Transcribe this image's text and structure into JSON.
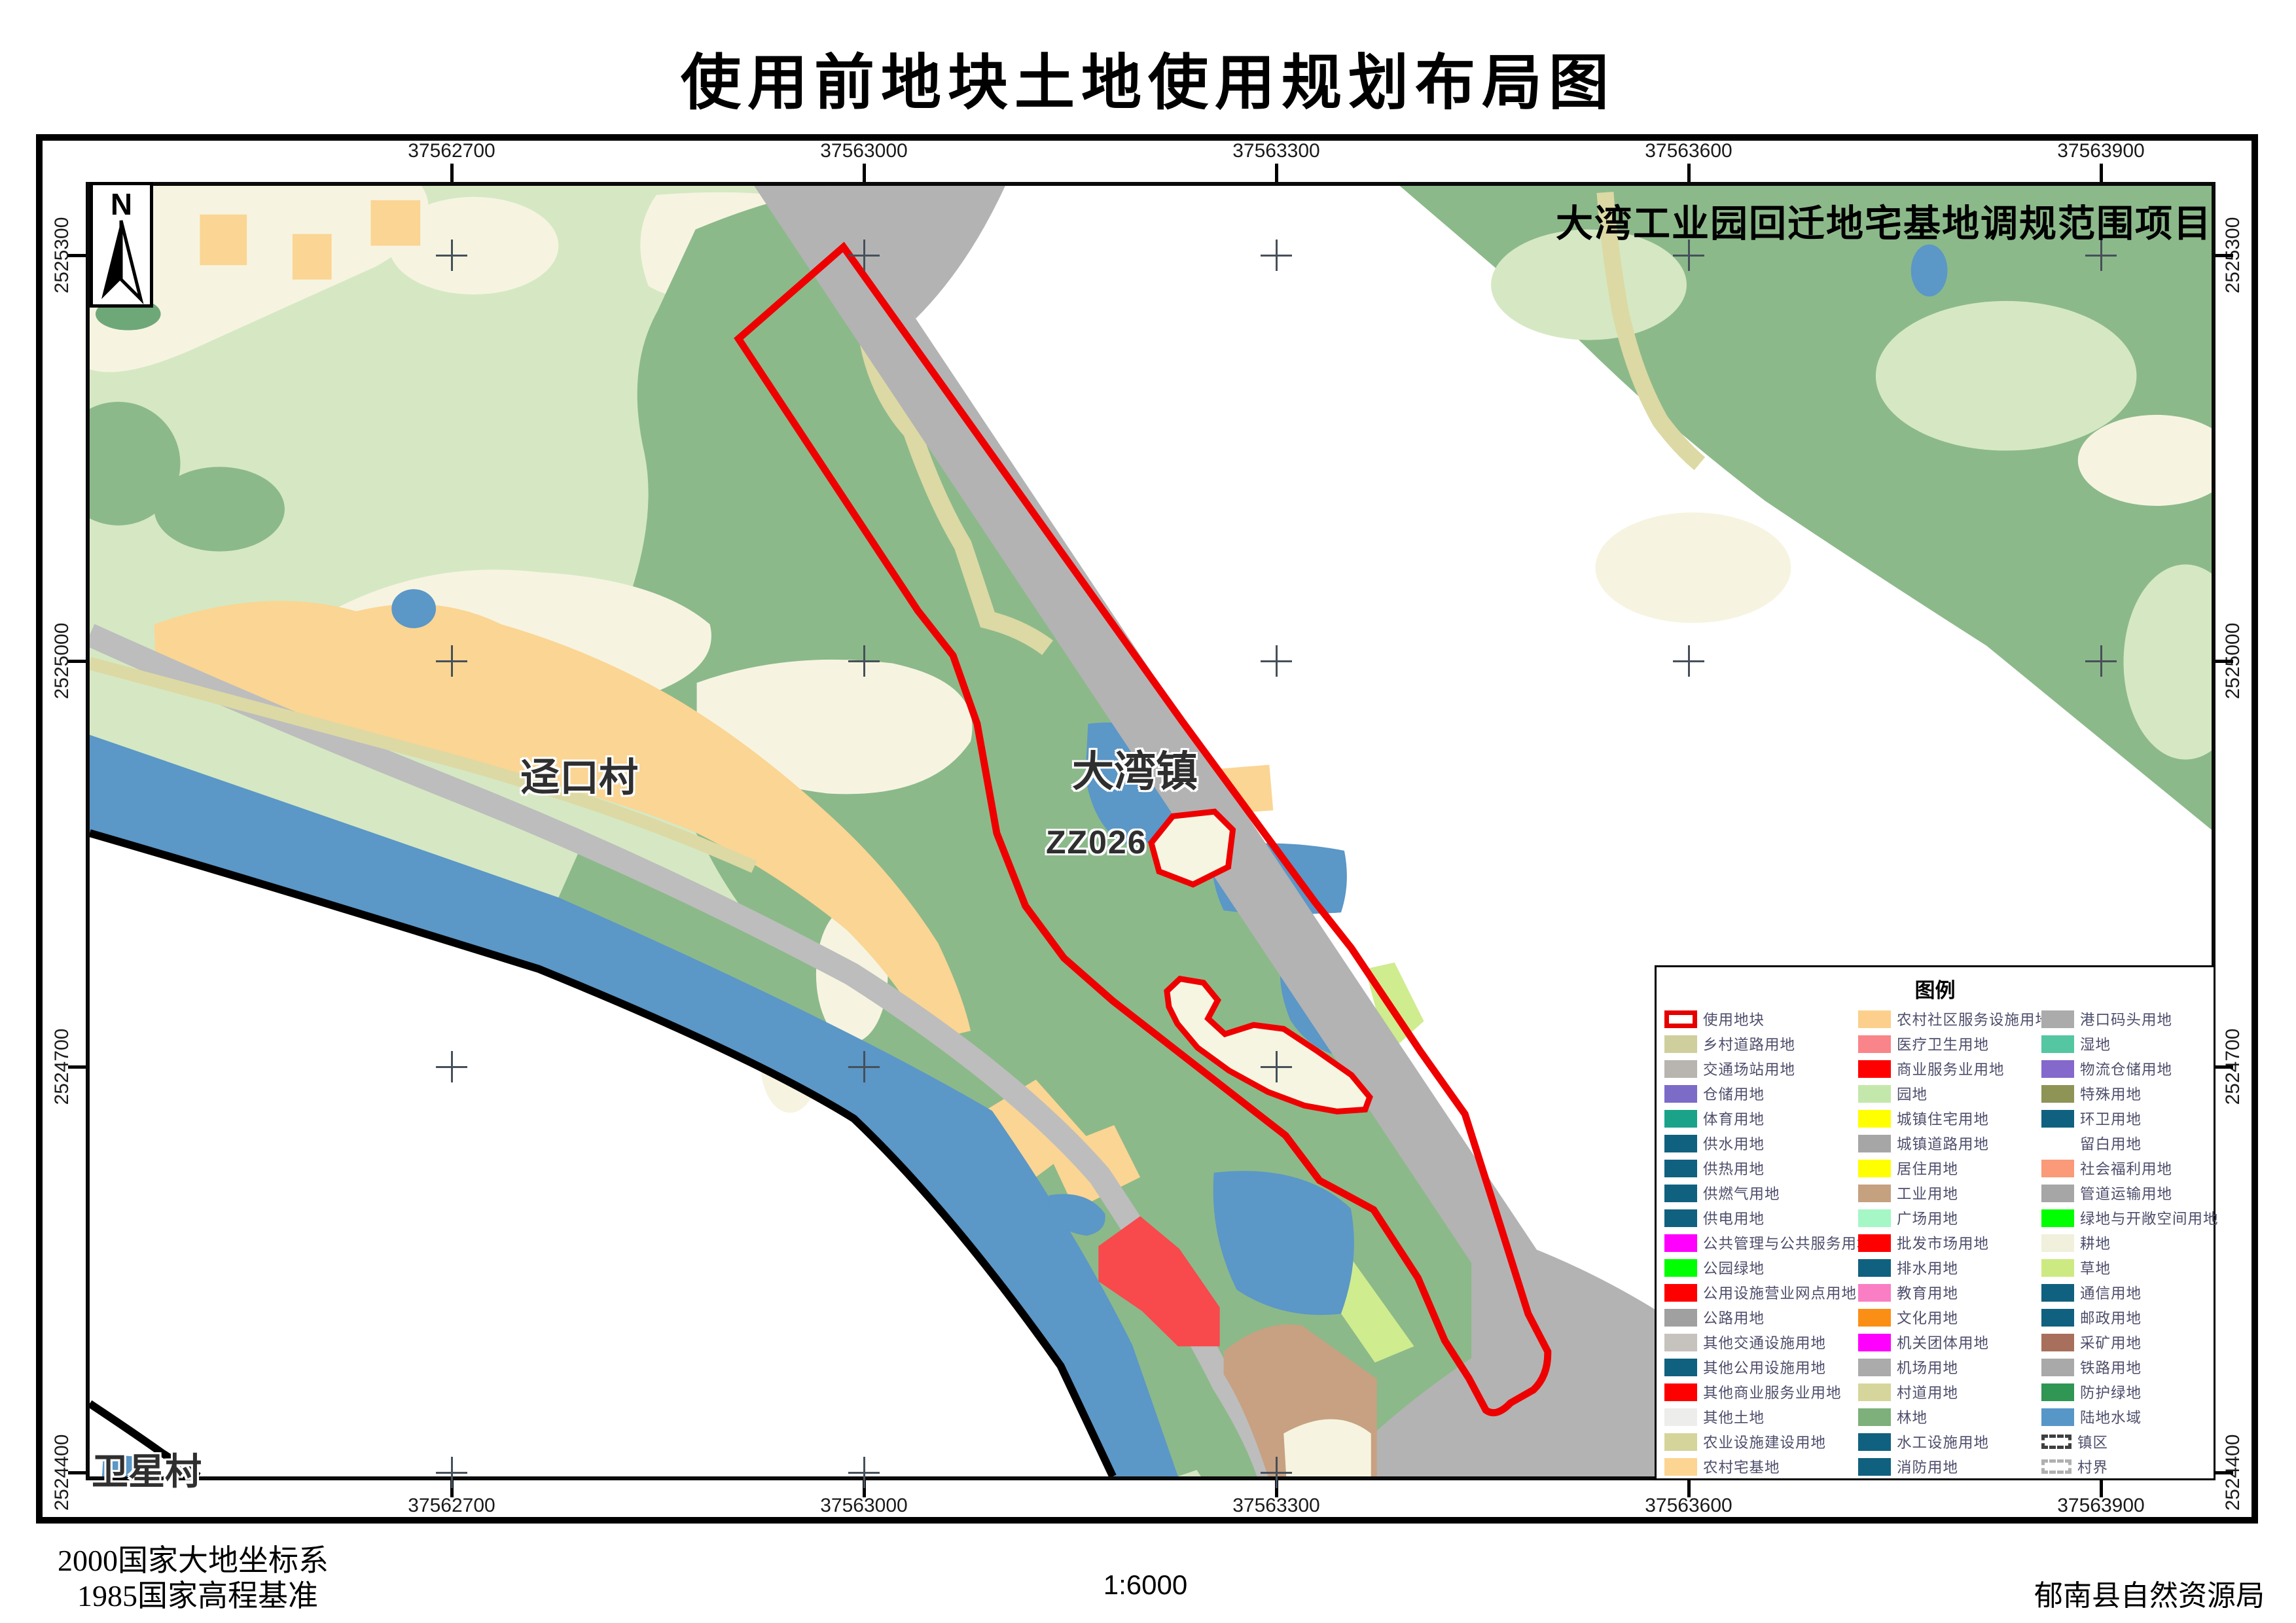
{
  "page": {
    "title": "使用前地块土地使用规划布局图"
  },
  "map": {
    "project_label": "大湾工业园回迁地宅基地调规范围项目",
    "north_label": "N",
    "labels": {
      "jingkou": "迳口村",
      "dawan": "大湾镇",
      "parcel_code": "ZZ026",
      "weixing": "卫星村"
    }
  },
  "grid": {
    "eastings": [
      "37562700",
      "37563000",
      "37563300",
      "37563600",
      "37563900"
    ],
    "northings": [
      "2525300",
      "2525000",
      "2524700",
      "2524400"
    ]
  },
  "legend": {
    "title": "图例",
    "columns": [
      [
        {
          "label": "使用地块",
          "swatch": "outline",
          "color": "#e60000"
        },
        {
          "label": "乡村道路用地",
          "swatch": "fill",
          "color": "#cfcf9e"
        },
        {
          "label": "交通场站用地",
          "swatch": "fill",
          "color": "#b8b4b0"
        },
        {
          "label": "仓储用地",
          "swatch": "fill",
          "color": "#7d6bc8"
        },
        {
          "label": "体育用地",
          "swatch": "fill",
          "color": "#1aa389"
        },
        {
          "label": "供水用地",
          "swatch": "fill",
          "color": "#10617f"
        },
        {
          "label": "供热用地",
          "swatch": "fill",
          "color": "#10617f"
        },
        {
          "label": "供燃气用地",
          "swatch": "fill",
          "color": "#10617f"
        },
        {
          "label": "供电用地",
          "swatch": "fill",
          "color": "#10617f"
        },
        {
          "label": "公共管理与公共服务用地",
          "swatch": "fill",
          "color": "#ff00ff"
        },
        {
          "label": "公园绿地",
          "swatch": "fill",
          "color": "#00ff00"
        },
        {
          "label": "公用设施营业网点用地",
          "swatch": "fill",
          "color": "#ff0000"
        },
        {
          "label": "公路用地",
          "swatch": "fill",
          "color": "#a0a0a0"
        },
        {
          "label": "其他交通设施用地",
          "swatch": "fill",
          "color": "#c6c2be"
        },
        {
          "label": "其他公用设施用地",
          "swatch": "fill",
          "color": "#10617f"
        },
        {
          "label": "其他商业服务业用地",
          "swatch": "fill",
          "color": "#ff0000"
        },
        {
          "label": "其他土地",
          "swatch": "fill",
          "color": "#ededeb"
        },
        {
          "label": "农业设施建设用地",
          "swatch": "fill",
          "color": "#d5d59b"
        },
        {
          "label": "农村宅基地",
          "swatch": "fill",
          "color": "#fcd592"
        }
      ],
      [
        {
          "label": "农村社区服务设施用地",
          "swatch": "fill",
          "color": "#fcd08c"
        },
        {
          "label": "医疗卫生用地",
          "swatch": "fill",
          "color": "#f9858a"
        },
        {
          "label": "商业服务业用地",
          "swatch": "fill",
          "color": "#ff0000"
        },
        {
          "label": "园地",
          "swatch": "fill",
          "color": "#c4e8ab"
        },
        {
          "label": "城镇住宅用地",
          "swatch": "fill",
          "color": "#ffff00"
        },
        {
          "label": "城镇道路用地",
          "swatch": "fill",
          "color": "#a6a6a6"
        },
        {
          "label": "居住用地",
          "swatch": "fill",
          "color": "#ffff00"
        },
        {
          "label": "工业用地",
          "swatch": "fill",
          "color": "#c5a180"
        },
        {
          "label": "广场用地",
          "swatch": "fill",
          "color": "#a5f7c6"
        },
        {
          "label": "批发市场用地",
          "swatch": "fill",
          "color": "#ff0000"
        },
        {
          "label": "排水用地",
          "swatch": "fill",
          "color": "#10617f"
        },
        {
          "label": "教育用地",
          "swatch": "fill",
          "color": "#fa7ec4"
        },
        {
          "label": "文化用地",
          "swatch": "fill",
          "color": "#fb8e14"
        },
        {
          "label": "机关团体用地",
          "swatch": "fill",
          "color": "#ff00ff"
        },
        {
          "label": "机场用地",
          "swatch": "fill",
          "color": "#ababab"
        },
        {
          "label": "村道用地",
          "swatch": "fill",
          "color": "#d6d69c"
        },
        {
          "label": "林地",
          "swatch": "fill",
          "color": "#7db07a"
        },
        {
          "label": "水工设施用地",
          "swatch": "fill",
          "color": "#10617f"
        },
        {
          "label": "消防用地",
          "swatch": "fill",
          "color": "#10617f"
        }
      ],
      [
        {
          "label": "港口码头用地",
          "swatch": "fill",
          "color": "#ababab"
        },
        {
          "label": "湿地",
          "swatch": "fill",
          "color": "#54c6a2"
        },
        {
          "label": "物流仓储用地",
          "swatch": "fill",
          "color": "#8468cc"
        },
        {
          "label": "特殊用地",
          "swatch": "fill",
          "color": "#8d9456"
        },
        {
          "label": "环卫用地",
          "swatch": "fill",
          "color": "#10617f"
        },
        {
          "label": "留白用地",
          "swatch": "blank",
          "color": "#ffffff"
        },
        {
          "label": "社会福利用地",
          "swatch": "fill",
          "color": "#fa9a78"
        },
        {
          "label": "管道运输用地",
          "swatch": "fill",
          "color": "#a6a6a6"
        },
        {
          "label": "绿地与开敞空间用地",
          "swatch": "fill",
          "color": "#00ff00"
        },
        {
          "label": "耕地",
          "swatch": "fill",
          "color": "#f1f0dc"
        },
        {
          "label": "草地",
          "swatch": "fill",
          "color": "#cdea82"
        },
        {
          "label": "通信用地",
          "swatch": "fill",
          "color": "#10617f"
        },
        {
          "label": "邮政用地",
          "swatch": "fill",
          "color": "#10617f"
        },
        {
          "label": "采矿用地",
          "swatch": "fill",
          "color": "#a8705c"
        },
        {
          "label": "铁路用地",
          "swatch": "fill",
          "color": "#a9a9a9"
        },
        {
          "label": "防护绿地",
          "swatch": "fill",
          "color": "#2f9653"
        },
        {
          "label": "陆地水域",
          "swatch": "fill",
          "color": "#5797c8"
        },
        {
          "label": "镇区",
          "swatch": "bracket-dark",
          "color": "#3f3f3f"
        },
        {
          "label": "村界",
          "swatch": "bracket-light",
          "color": "#b0b0b0"
        }
      ]
    ]
  },
  "footer": {
    "datum_line1": "2000国家大地坐标系",
    "datum_line2": "1985国家高程基准",
    "scale": "1:6000",
    "agency": "郁南县自然资源局"
  },
  "colors": {
    "use_parcel_outline": "#ee0000",
    "water": "#5b97c7",
    "forest": "#8cb98a",
    "orchard": "#d5e8c3",
    "cropland": "#f6f4e0",
    "village_residential": "#fbd593",
    "road_gray": "#b3b3b3",
    "village_road": "#dcd9a4",
    "industrial": "#c7a181",
    "commercial_red": "#f8494d",
    "boundary_black": "#000000"
  }
}
